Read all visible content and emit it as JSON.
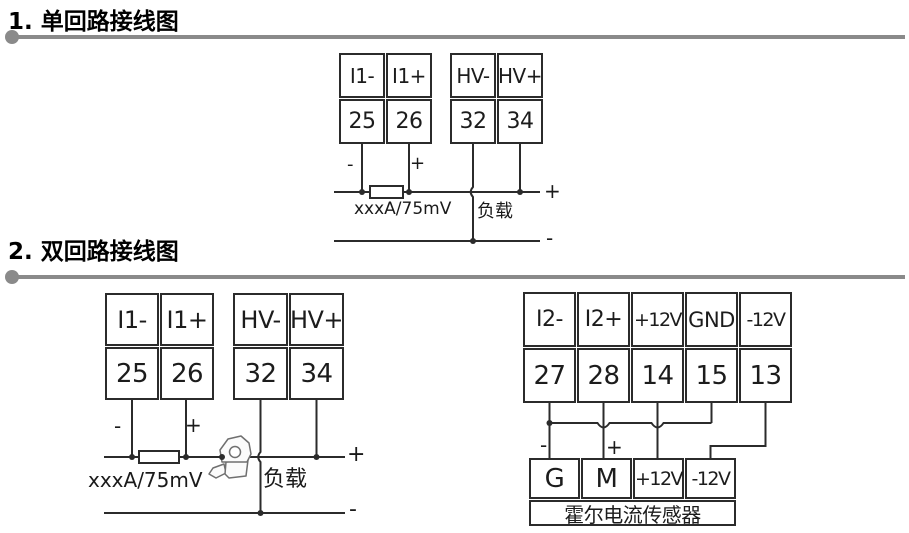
{
  "colors": {
    "wire": "#2b2b2b",
    "separator": "#8a8a8a",
    "text": "#111111"
  },
  "sections": [
    {
      "title": "1. 单回路接线图"
    },
    {
      "title": "2. 双回路接线图"
    }
  ],
  "s1": {
    "block_i1": {
      "labels": [
        "I1-",
        "I1+"
      ],
      "terminals": [
        "25",
        "26"
      ]
    },
    "block_hv": {
      "labels": [
        "HV-",
        "HV+"
      ],
      "terminals": [
        "32",
        "34"
      ]
    },
    "minus": "-",
    "plus": "+",
    "shunt_label": "xxxA/75mV",
    "load_label": "负载",
    "bus_plus": "+",
    "bus_minus": "-"
  },
  "s2": {
    "block_i1": {
      "labels": [
        "I1-",
        "I1+"
      ],
      "terminals": [
        "25",
        "26"
      ]
    },
    "block_hv": {
      "labels": [
        "HV-",
        "HV+"
      ],
      "terminals": [
        "32",
        "34"
      ]
    },
    "block_i2": {
      "labels": [
        "I2-",
        "I2+",
        "+12V",
        "GND",
        "-12V"
      ],
      "terminals": [
        "27",
        "28",
        "14",
        "15",
        "13"
      ]
    },
    "sensor": {
      "labels": [
        "G",
        "M",
        "+12V",
        "-12V"
      ],
      "name": "霍尔电流传感器"
    },
    "left": {
      "minus": "-",
      "plus": "+",
      "shunt_label": "xxxA/75mV",
      "load_label": "负载",
      "bus_plus": "+",
      "bus_minus": "-"
    },
    "right": {
      "minus": "-",
      "plus": "+"
    }
  }
}
